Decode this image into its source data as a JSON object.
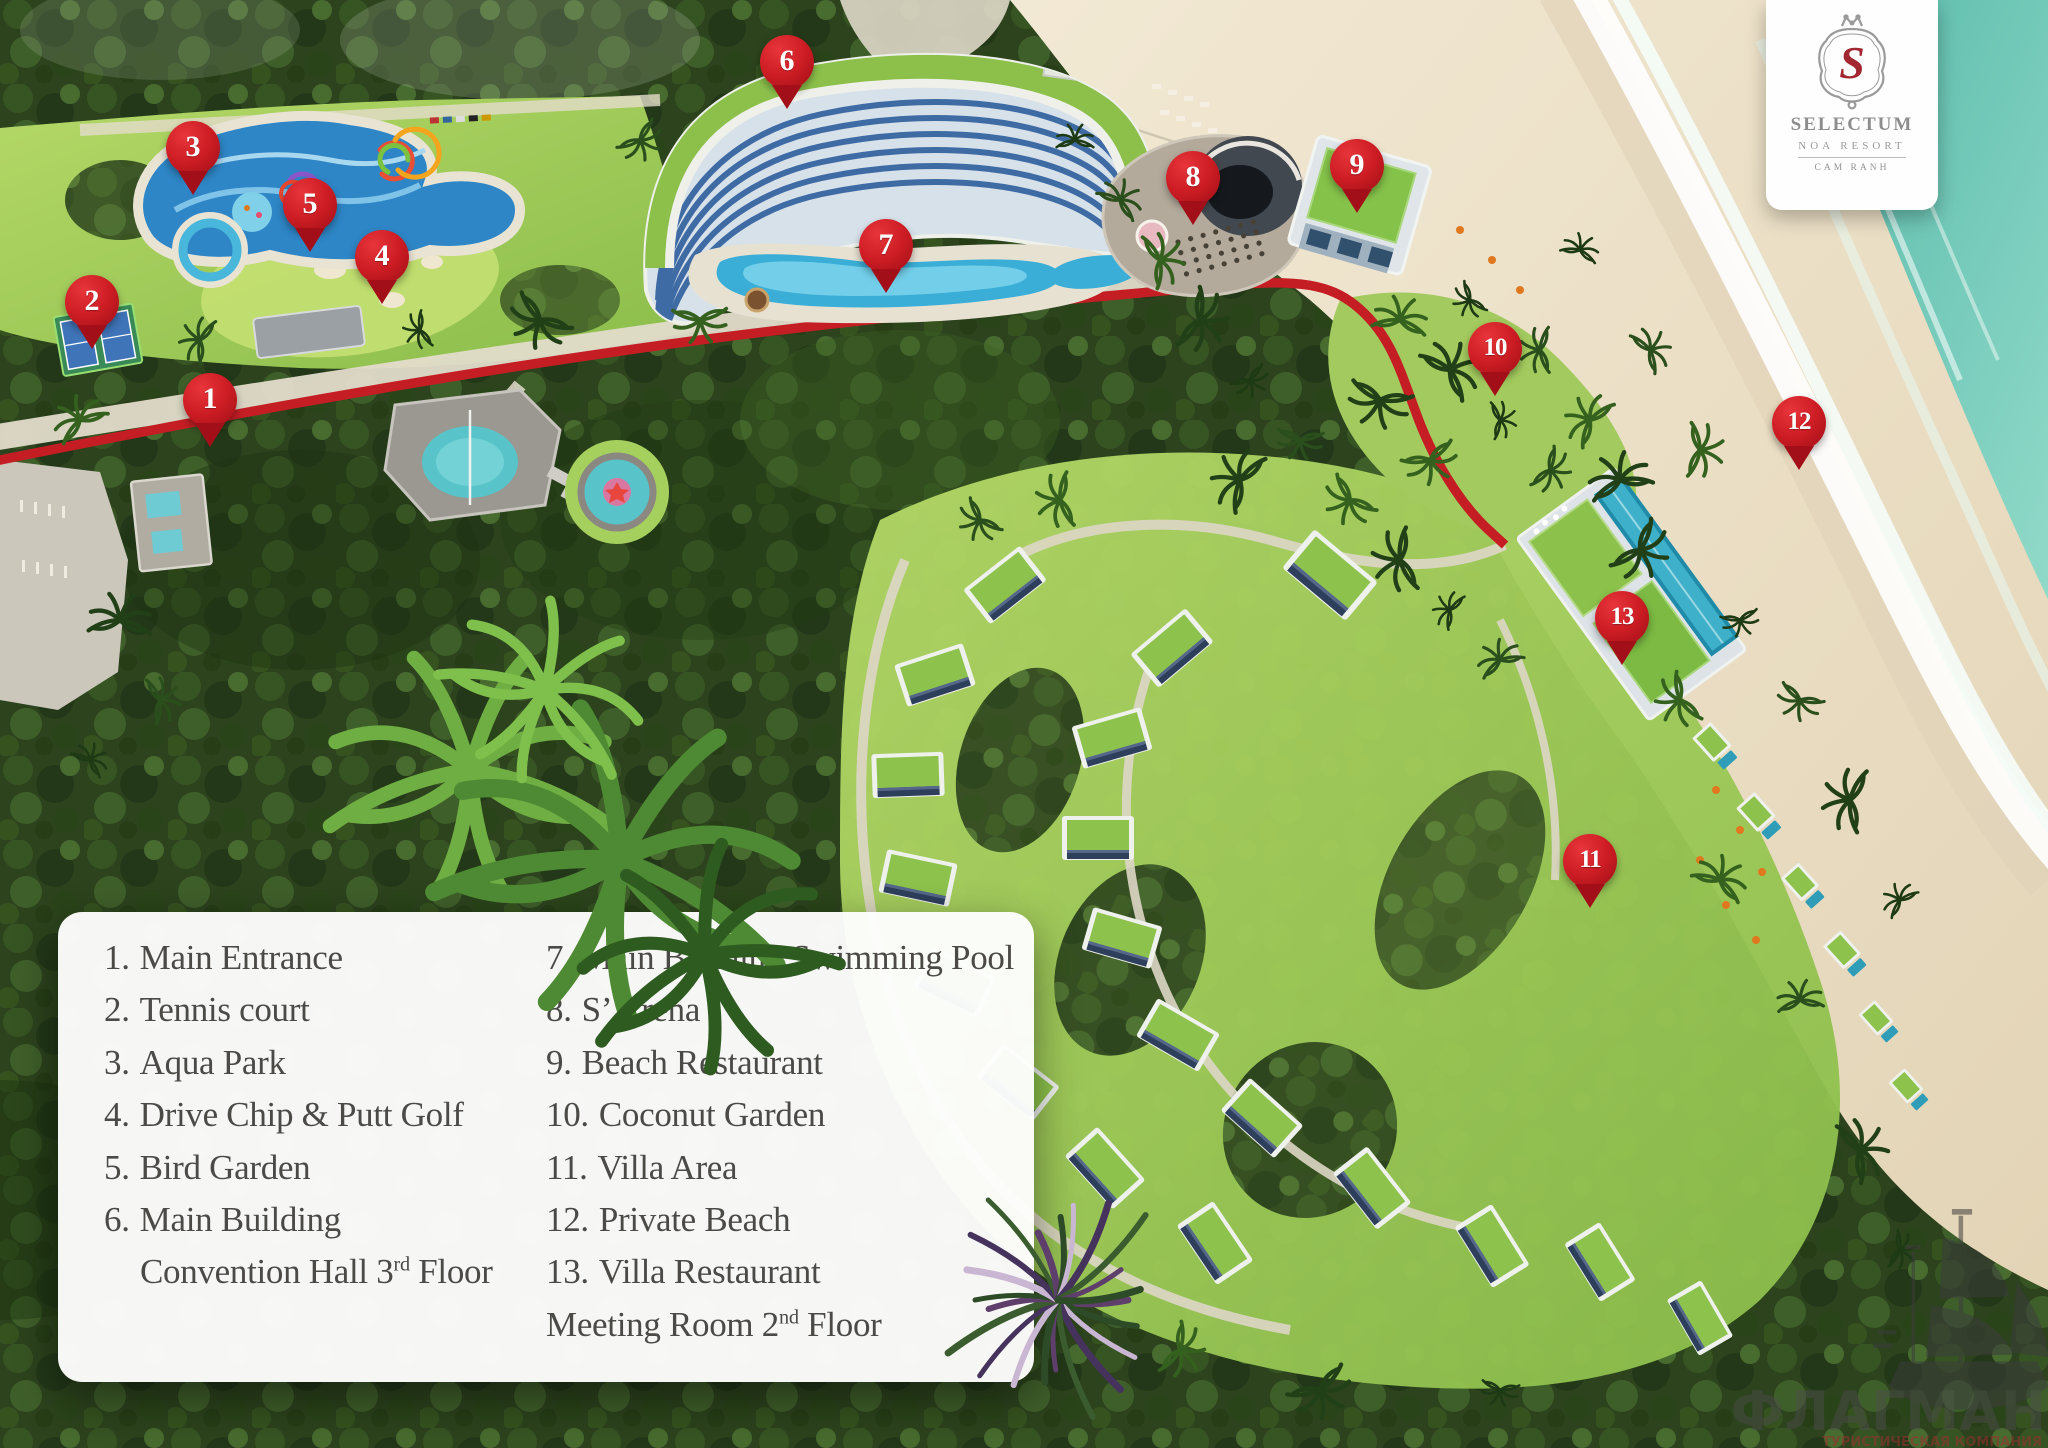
{
  "meta": {
    "title": "Selectum Noa Resort Cam Ranh — Resort Map"
  },
  "logo": {
    "monogram": "S",
    "name": "SELECTUM",
    "subtitle": "NOA RESORT",
    "location": "CAM RANH"
  },
  "legend": {
    "left": [
      {
        "num": "1.",
        "label": "Main Entrance"
      },
      {
        "num": "2.",
        "label": "Tennis court"
      },
      {
        "num": "3.",
        "label": "Aqua Park"
      },
      {
        "num": "4.",
        "label": "Drive Chip & Putt Golf"
      },
      {
        "num": "5.",
        "label": "Bird Garden"
      },
      {
        "num": "6.",
        "label": "Main Building"
      },
      {
        "cont": true,
        "indent": true,
        "pre": "Convention Hall 3",
        "sup": "rd",
        "post": " Floor"
      }
    ],
    "right": [
      {
        "num": "7.",
        "label": "Main Building Swimming Pool"
      },
      {
        "num": "8.",
        "label": "S’ Arena"
      },
      {
        "num": "9.",
        "label": "Beach Restaurant"
      },
      {
        "num": "10.",
        "label": "Coconut Garden"
      },
      {
        "num": "11.",
        "label": "Villa Area"
      },
      {
        "num": "12.",
        "label": "Private Beach"
      },
      {
        "num": "13.",
        "label": "Villa Restaurant"
      },
      {
        "cont": true,
        "pre": "Meeting Room 2",
        "sup": "nd",
        "post": " Floor"
      }
    ]
  },
  "pins": [
    {
      "number": "1",
      "label": "Main Entrance",
      "x": 210,
      "y": 400
    },
    {
      "number": "2",
      "label": "Tennis court",
      "x": 92,
      "y": 302
    },
    {
      "number": "3",
      "label": "Aqua Park",
      "x": 193,
      "y": 148
    },
    {
      "number": "4",
      "label": "Drive Chip & Putt Golf",
      "x": 382,
      "y": 257
    },
    {
      "number": "5",
      "label": "Bird Garden",
      "x": 310,
      "y": 205
    },
    {
      "number": "6",
      "label": "Main Building",
      "x": 787,
      "y": 62
    },
    {
      "number": "7",
      "label": "Main Building Swimming Pool",
      "x": 886,
      "y": 246
    },
    {
      "number": "8",
      "label": "S’ Arena",
      "x": 1193,
      "y": 178
    },
    {
      "number": "9",
      "label": "Beach Restaurant",
      "x": 1357,
      "y": 166
    },
    {
      "number": "10",
      "label": "Coconut Garden",
      "x": 1495,
      "y": 349
    },
    {
      "number": "11",
      "label": "Villa Area",
      "x": 1590,
      "y": 861
    },
    {
      "number": "12",
      "label": "Private Beach",
      "x": 1799,
      "y": 423
    },
    {
      "number": "13",
      "label": "Villa Restaurant",
      "x": 1622,
      "y": 618
    }
  ],
  "watermark": {
    "name": "ФЛАГМАН",
    "tagline": "ТУРИСТИЧЕСКАЯ КОМПАНИЯ"
  },
  "colors": {
    "pin_red": "#ce1d24",
    "road_red": "#c41e24",
    "ocean_teal": "#6cc8b8",
    "sand": "#ecdfc7",
    "forest_dark": "#2c431d",
    "lawn_green": "#9dc653",
    "roof_green": "#8cc04b",
    "legend_text": "#4b4a47",
    "logo_red": "#a32730"
  }
}
